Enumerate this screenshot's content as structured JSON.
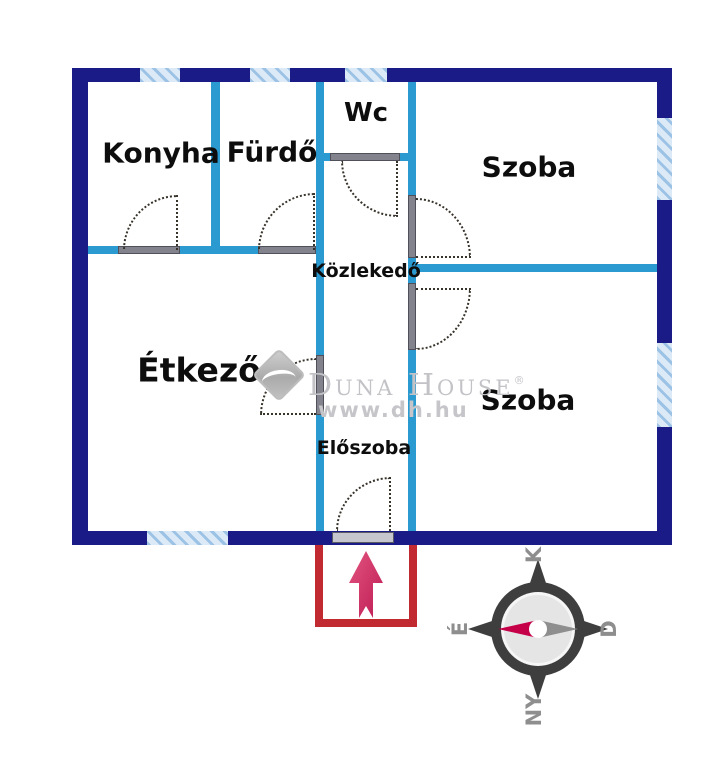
{
  "plan": {
    "rooms": {
      "konyha": "Konyha",
      "furdo": "Fürdő",
      "wc": "Wc",
      "szoba_top": "Szoba",
      "kozlekedo": "Közlekedő",
      "etkezo": "Étkező",
      "szoba_bottom": "Szoba",
      "eloszoba": "Előszoba"
    },
    "colors": {
      "outer_wall": "#1b1b87",
      "inner_wall": "#2b9ad1",
      "window_hatch": "#9cc3e6",
      "entrance_red": "#c02a30",
      "arrow_pink": "#d23a68",
      "compass_needle": "#c60048"
    }
  },
  "watermark": {
    "brand": "Duna House",
    "registered": "®",
    "url": "www.dh.hu"
  },
  "compass": {
    "top": "K",
    "right": "D",
    "bottom": "NY",
    "left": "É"
  }
}
